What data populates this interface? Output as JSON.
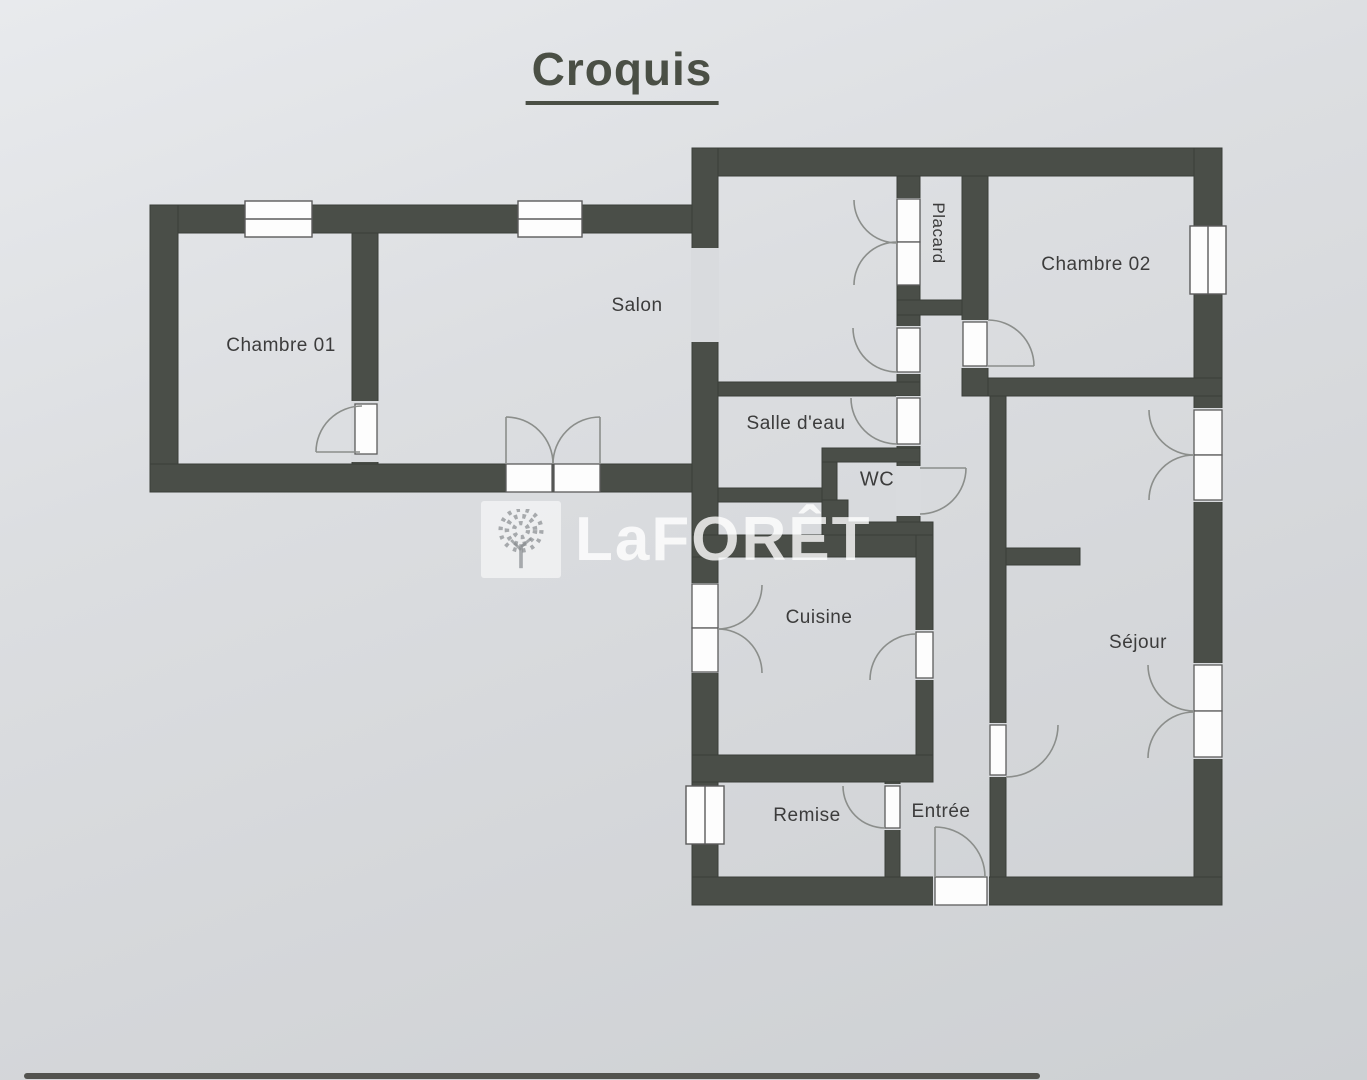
{
  "title": "Croquis",
  "watermark": {
    "brand": "LaFORÊT"
  },
  "rooms": {
    "chambre01": {
      "label": "Chambre 01"
    },
    "salon": {
      "label": "Salon"
    },
    "salle_deau": {
      "label": "Salle d'eau"
    },
    "wc": {
      "label": "WC"
    },
    "placard": {
      "label": "Placard"
    },
    "chambre02": {
      "label": "Chambre 02"
    },
    "cuisine": {
      "label": "Cuisine"
    },
    "sejour": {
      "label": "Séjour"
    },
    "remise": {
      "label": "Remise"
    },
    "entree": {
      "label": "Entrée"
    }
  },
  "colors": {
    "paper": "#d9dbde",
    "wall": "#4a4e48",
    "title_text": "#4a4f45",
    "label_text": "#3c3c3c",
    "door_arc": "#8b8e8b",
    "window_fill": "#fdfdfd",
    "watermark_text": "rgba(255,255,255,0.8)"
  }
}
